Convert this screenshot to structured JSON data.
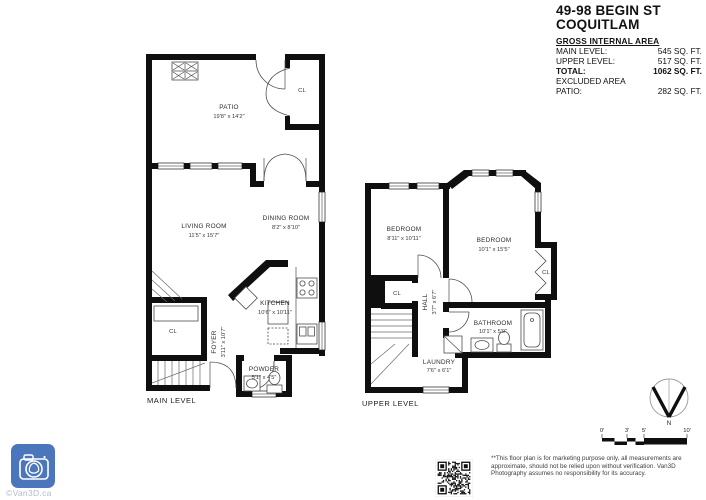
{
  "header": {
    "title_line1": "49-98 BEGIN ST",
    "title_line2": "COQUITLAM",
    "gross_heading": "GROSS INTERNAL AREA",
    "area_rows": [
      {
        "label": "MAIN LEVEL:",
        "value": "545 SQ. FT."
      },
      {
        "label": "UPPER LEVEL:",
        "value": "517 SQ. FT."
      },
      {
        "label": "TOTAL:",
        "value": "1062 SQ. FT."
      }
    ],
    "excluded_heading": "EXCLUDED AREA",
    "excluded_rows": [
      {
        "label": "PATIO:",
        "value": "282 SQ. FT."
      }
    ]
  },
  "main_level": {
    "label": "MAIN LEVEL",
    "patio_name": "PATIO",
    "patio_dims": "19'8\" x 14'2\"",
    "patio_closet": "CL",
    "living_name": "LIVING ROOM",
    "living_dims": "11'5\" x 15'7\"",
    "dining_name": "DINING ROOM",
    "dining_dims": "8'2\" x 8'10\"",
    "kitchen_name": "KITCHEN",
    "kitchen_dims": "10'6\" x 10'11\"",
    "foyer_name": "FOYER",
    "foyer_dims": "3'11\" x 10'7\"",
    "foyer_closet": "CL",
    "powder_name": "POWDER",
    "powder_dims": "5'1\" x 4'5\""
  },
  "upper_level": {
    "label": "UPPER LEVEL",
    "bedroom1_name": "BEDROOM",
    "bedroom1_dims": "8'11\" x 10'11\"",
    "bedroom2_name": "BEDROOM",
    "bedroom2_dims": "10'1\" x 15'5\"",
    "bedroom2_closet": "CL",
    "hall_closet": "CL",
    "hall_name": "HALL",
    "hall_dims": "3'7\" x 6'7\"",
    "bathroom_name": "BATHROOM",
    "bathroom_dims": "10'1\" x 5'9\"",
    "laundry_name": "LAUNDRY",
    "laundry_dims": "7'6\" x 6'1\""
  },
  "compass": {
    "north_label": "N"
  },
  "scale_bar": {
    "ticks": [
      "0'",
      "3'",
      "5'",
      "10'"
    ]
  },
  "footer": {
    "logo_caption": "©Van3D.ca",
    "disclaimer": "**This floor plan is for marketing purpose only, all measurements are approximate, should not be relied upon without verification. Van3D Photography assumes no responsibility for its accuracy."
  },
  "colors": {
    "wall": "#0f0f0f",
    "logo_blue": "#4b76bb",
    "logo_caption": "#b3bdc9"
  }
}
